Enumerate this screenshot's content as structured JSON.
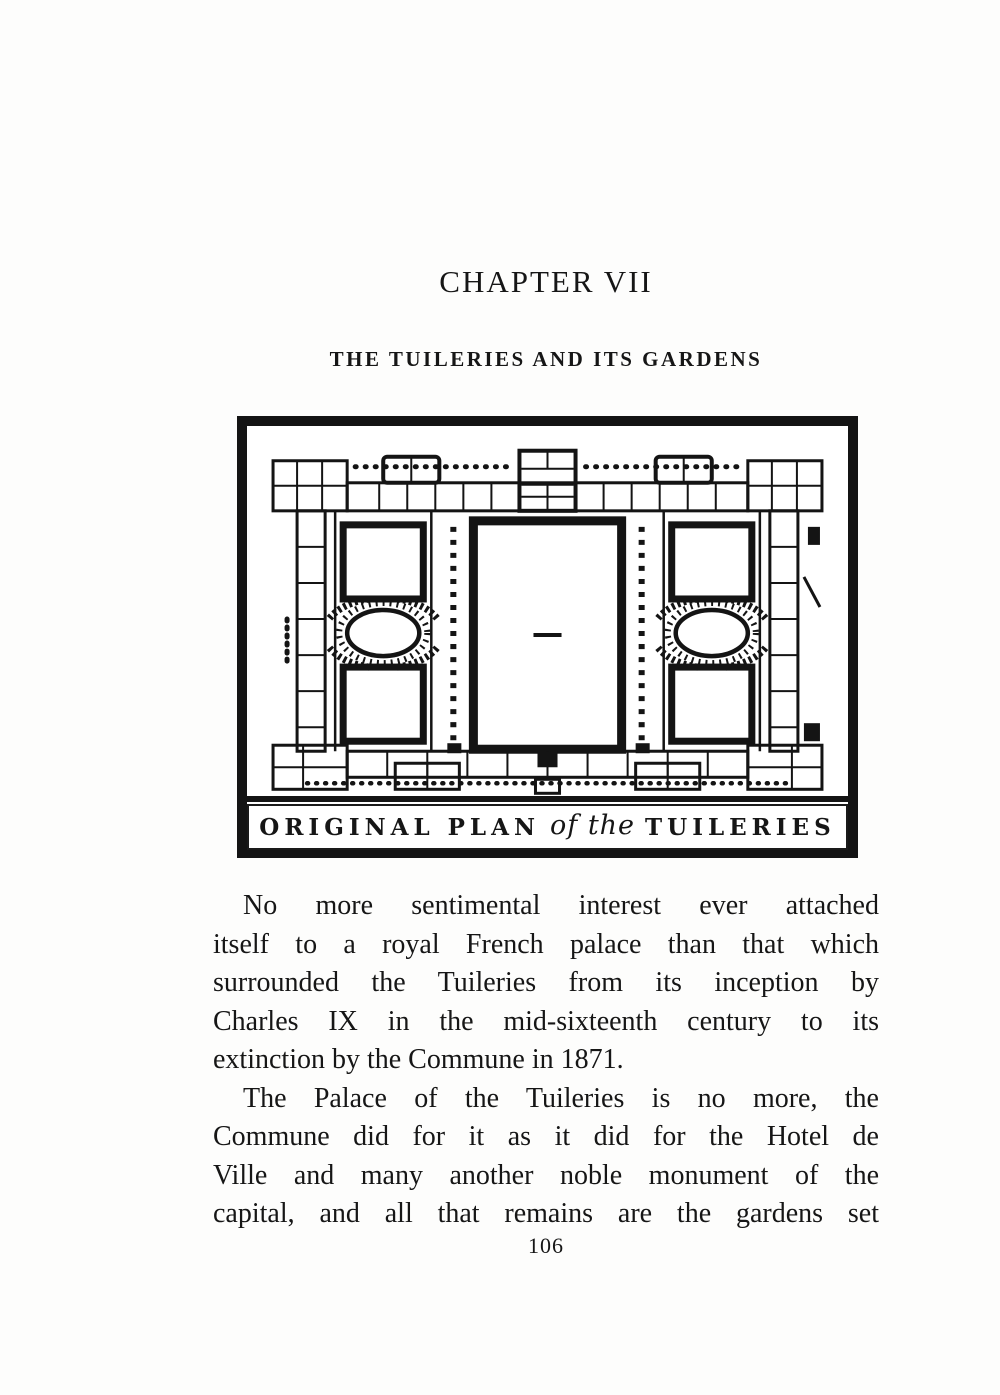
{
  "page": {
    "chapter_heading": "CHAPTER VII",
    "chapter_subtitle": "THE TUILERIES AND ITS GARDENS",
    "page_number": "106"
  },
  "figure": {
    "caption": {
      "part1": "ORIGINAL PLAN",
      "script": "of the",
      "part2": "TUILERIES"
    }
  },
  "body": {
    "paragraph1": {
      "lines": [
        "No more sentimental interest ever attached",
        "itself to a royal French palace than that which",
        "surrounded the Tuileries from its inception by",
        "Charles IX in the mid-sixteenth century to its",
        "extinction by the Commune in 1871."
      ]
    },
    "paragraph2": {
      "lines": [
        "The Palace of the Tuileries is no more, the",
        "Commune did for it as it did for the Hotel de",
        "Ville and many another noble monument of the",
        "capital, and all that remains are the gardens set"
      ]
    }
  },
  "colors": {
    "ink": "#161616",
    "paper": "#fdfdfc"
  }
}
